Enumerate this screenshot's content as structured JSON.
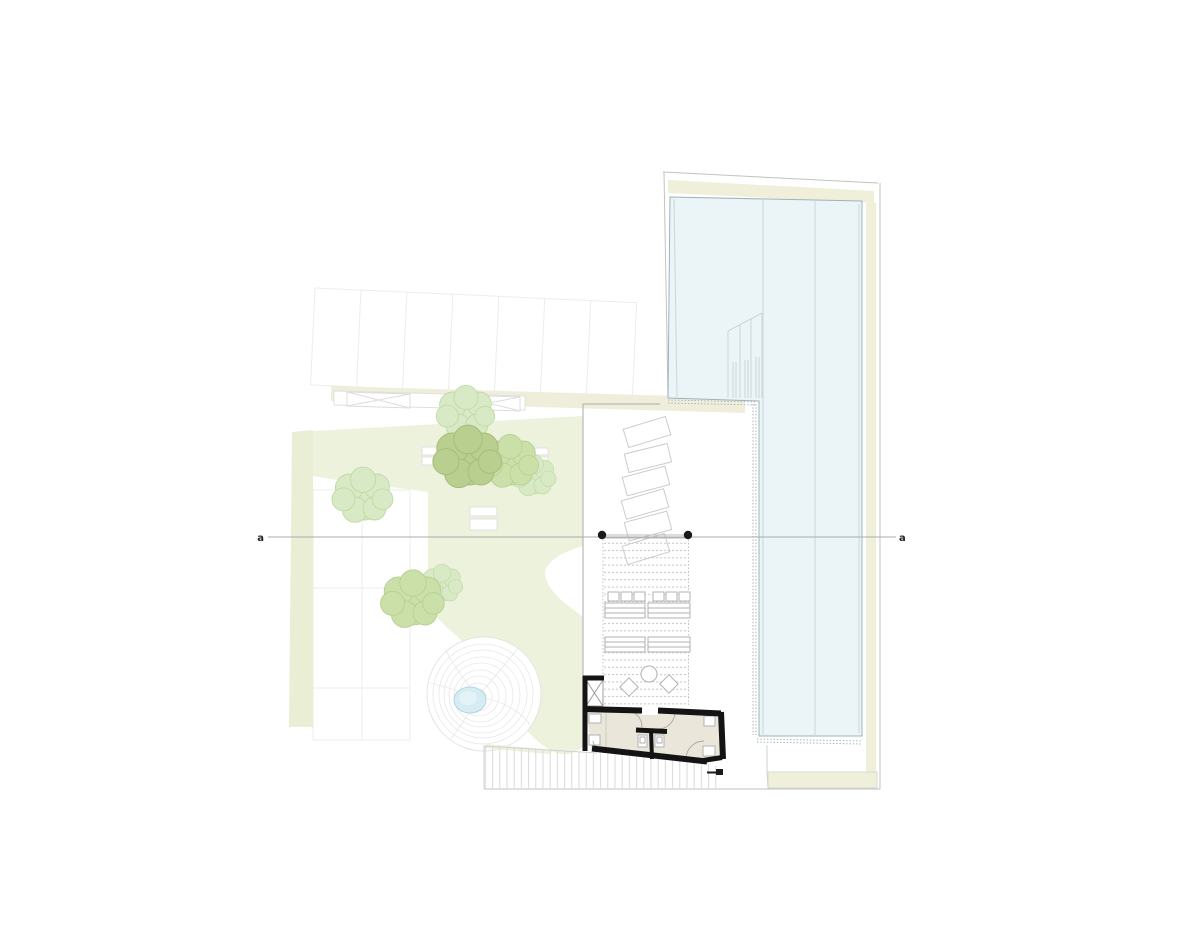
{
  "section_line": {
    "left_label": "a",
    "right_label": "a"
  },
  "colors": {
    "background": "#ffffff",
    "glass": "#ebf5f8",
    "glass_stroke": "#9fb3ba",
    "cream": "#f0efda",
    "garden": "#edf2dc",
    "band_green": "#e9eed5",
    "strip": "#eeeedb",
    "tree_light": "#d8e9c6",
    "tree_light_stroke": "#c2d9a4",
    "tree_olive": "#b9cf90",
    "tree_olive_stroke": "#a6bd7c",
    "tree_mid": "#cbe0a9",
    "tree_mid_stroke": "#b7d093",
    "pond": "#d6ecf3",
    "pond_inner": "#e4f3f7",
    "pond_stroke": "#aed7e2",
    "wall": "#141414",
    "interior": "#eae6d9",
    "furniture": "#b2b2b2",
    "section": "#ababab",
    "marker": "#1a1a1a",
    "stall_x": "#dcdcdc"
  }
}
